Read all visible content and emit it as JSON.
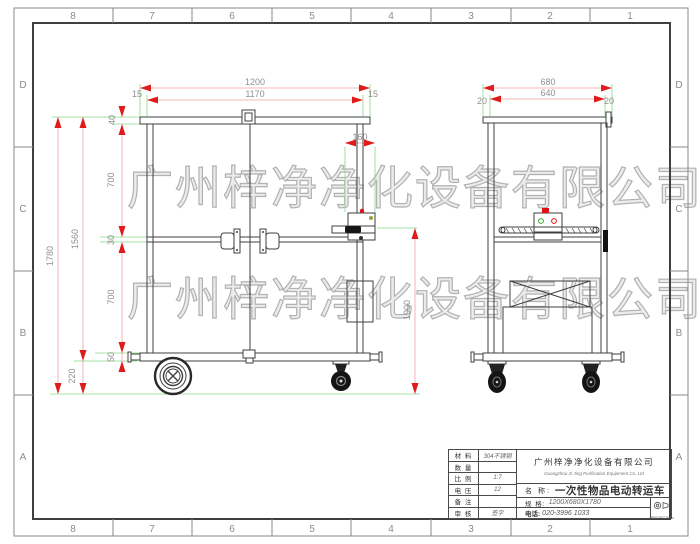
{
  "drawing": {
    "watermark_text": "广州梓净净化设备有限公司",
    "zones": {
      "columns": [
        "8",
        "7",
        "6",
        "5",
        "4",
        "3",
        "2",
        "1"
      ],
      "rows": [
        "D",
        "C",
        "B",
        "A"
      ]
    },
    "front_view": {
      "dim_width_overall": "1200",
      "dim_width_inner": "1170",
      "dim_side_left": "15",
      "dim_side_right": "15",
      "dim_cap": "40",
      "dim_upper": "700",
      "dim_mid_rail": "30",
      "dim_lower": "700",
      "dim_base": "50",
      "dim_body_height": "1560",
      "dim_total_height": "1780",
      "dim_ground_clearance": "220",
      "dim_control_box": "160",
      "dim_handle_height": "1000"
    },
    "side_view": {
      "dim_width_overall": "680",
      "dim_width_inner": "640",
      "dim_side_left": "20",
      "dim_side_right": "20"
    },
    "title_block": {
      "rows": [
        {
          "label": "材 料",
          "value": "304不锈钢"
        },
        {
          "label": "数 量",
          "value": ""
        },
        {
          "label": "比 例",
          "value": "1:7"
        },
        {
          "label": "电 压",
          "value": "12"
        },
        {
          "label": "备 注",
          "value": ""
        },
        {
          "label": "审 核",
          "value": "签字"
        }
      ],
      "company_cn": "广州梓净净化设备有限公司",
      "company_en": "Guangzhou Zi Jing Purification Equipment Co. Ltd",
      "name_label": "名  称:",
      "name_value": "一次性物品电动转运车",
      "spec_label": "规  格:",
      "spec_value": "1200X680X1780",
      "phone_label": "电话:",
      "phone_value": "020-3996 1033",
      "projection": "PROJECTION"
    }
  }
}
